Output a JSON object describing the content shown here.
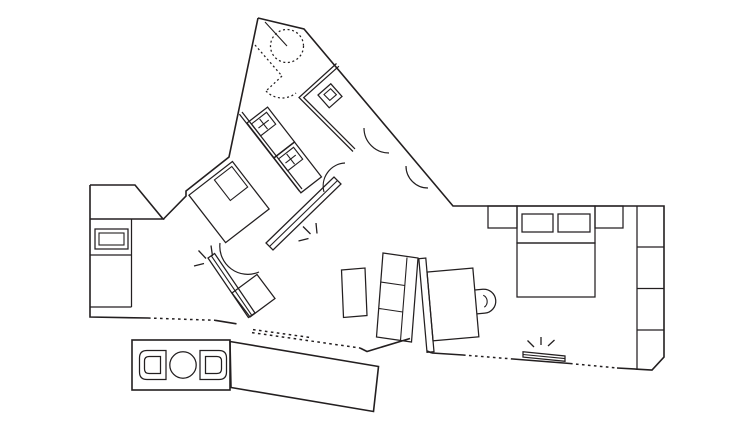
{
  "meta": {
    "title": "Architectural floor plan — line drawing of an angled house with deck",
    "drawing_type": "floor-plan"
  },
  "palette": {
    "background": "#ffffff",
    "line": "#231f20"
  },
  "plan": {
    "zones": [
      "entry-hall",
      "wc",
      "corridor",
      "kids-bedroom",
      "left-bedroom",
      "kitchen",
      "living-area",
      "right-bedroom",
      "outdoor-deck"
    ],
    "furniture": [
      "kitchen-counter",
      "kitchen-sink",
      "double-bed-angled",
      "twin-bed-1",
      "twin-bed-2",
      "wc-fixture",
      "bench-heater",
      "corner-heater",
      "square-side-table",
      "coffee-table",
      "sofa-three-seat",
      "wood-stove",
      "nightstand-left",
      "double-bed-right",
      "pillow-left",
      "pillow-right",
      "nightstand-right",
      "wardrobe-four-cells",
      "floor-threshold",
      "round-outdoor-table",
      "outdoor-chair-left",
      "outdoor-chair-right"
    ],
    "symbols": [
      "dashed-ceiling-circle",
      "dashed-door-swing",
      "door-swing-arcs",
      "glazed-wall-dashed-lines",
      "light-burst-marks",
      "deck-plank-hatching"
    ]
  }
}
